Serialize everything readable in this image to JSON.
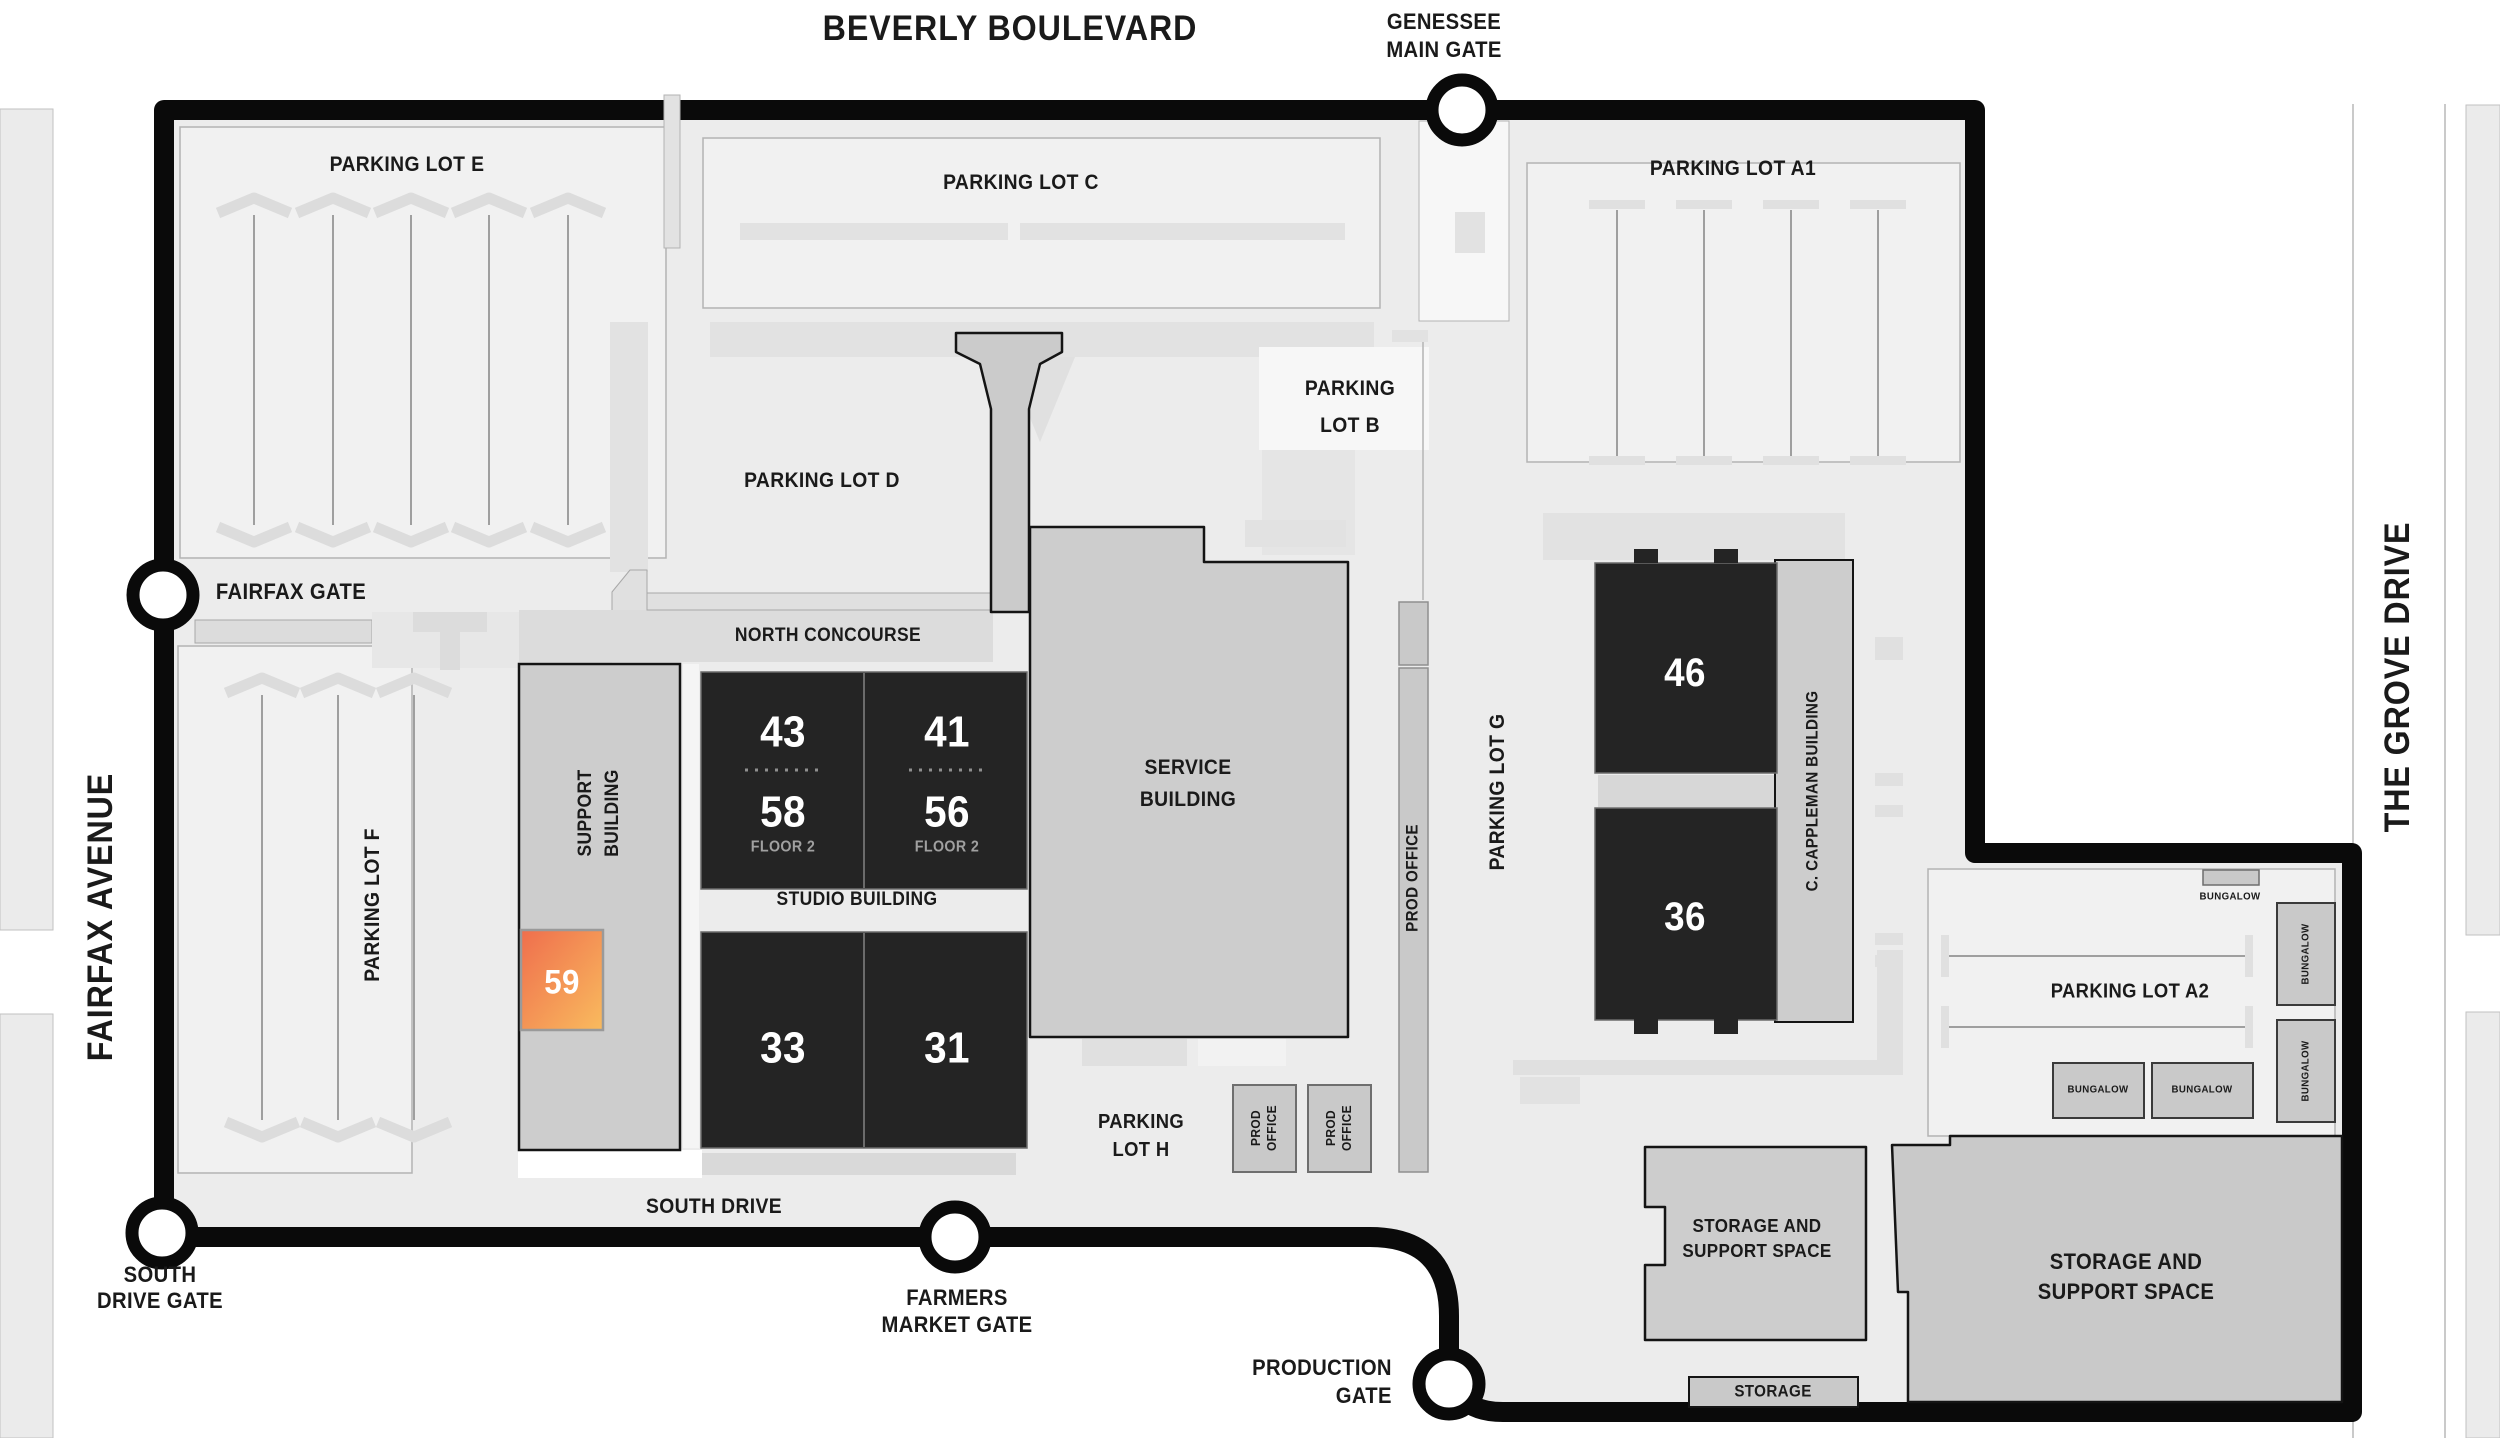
{
  "streets": {
    "beverly": "BEVERLY BOULEVARD",
    "fairfax": "FAIRFAX AVENUE",
    "grove": "THE GROVE DRIVE"
  },
  "gates": {
    "genessee": [
      "GENESSEE",
      "MAIN GATE"
    ],
    "fairfax": [
      "FAIRFAX GATE"
    ],
    "south": [
      "SOUTH",
      "DRIVE GATE"
    ],
    "farmers": [
      "FARMERS",
      "MARKET GATE"
    ],
    "production": [
      "PRODUCTION",
      "GATE"
    ]
  },
  "lots": {
    "e": "PARKING LOT E",
    "c": "PARKING LOT C",
    "a1": "PARKING LOT A1",
    "b": [
      "PARKING",
      "LOT B"
    ],
    "d": "PARKING LOT D",
    "f": "PARKING LOT F",
    "g": "PARKING LOT G",
    "h": [
      "PARKING",
      "LOT H"
    ],
    "a2": "PARKING LOT A2"
  },
  "roads": {
    "north_concourse": "NORTH CONCOURSE",
    "south_drive": "SOUTH DRIVE"
  },
  "buildings": {
    "support": [
      "SUPPORT",
      "BUILDING"
    ],
    "studio": "STUDIO BUILDING",
    "service": [
      "SERVICE",
      "BUILDING"
    ],
    "cappleman": "C. CAPPLEMAN BUILDING",
    "prod_office": "PROD OFFICE",
    "prod_office_small": [
      "PROD",
      "OFFICE"
    ],
    "storage_support": [
      "STORAGE AND",
      "SUPPORT SPACE"
    ],
    "storage": "STORAGE",
    "bungalow": "BUNGALOW"
  },
  "stages": {
    "s43": "43",
    "s41": "41",
    "s58": "58",
    "s56": "56",
    "s33": "33",
    "s31": "31",
    "s46": "46",
    "s36": "36",
    "s59": "59",
    "floor2": "FLOOR 2"
  },
  "colors": {
    "lot_background": "#ececec",
    "building_fill": "#cdcdcd",
    "stage_fill": "#242424",
    "boundary": "#0a0a0a",
    "highlight_from": "#ef6e4d",
    "highlight_to": "#f9bb5e"
  }
}
